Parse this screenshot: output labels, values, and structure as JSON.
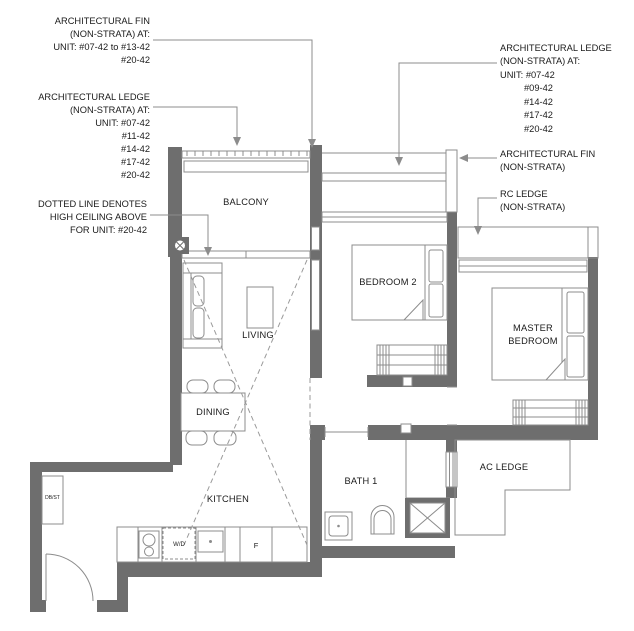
{
  "plan": {
    "annotations": {
      "fin_left": [
        "ARCHITECTURAL FIN",
        "(NON-STRATA) AT:",
        "UNIT: #07-42 to #13-42",
        "#20-42"
      ],
      "ledge_left": [
        "ARCHITECTURAL LEDGE",
        "(NON-STRATA) AT:",
        "UNIT: #07-42",
        "#11-42",
        "#14-42",
        "#17-42",
        "#20-42"
      ],
      "dotted": [
        "DOTTED LINE DENOTES",
        "HIGH CEILING ABOVE",
        "FOR UNIT: #20-42"
      ],
      "ledge_right": [
        "ARCHITECTURAL LEDGE",
        "(NON-STRATA) AT:",
        "UNIT: #07-42",
        "#09-42",
        "#14-42",
        "#17-42",
        "#20-42"
      ],
      "fin_right": [
        "ARCHITECTURAL FIN",
        "(NON-STRATA)"
      ],
      "rc_ledge": [
        "RC LEDGE",
        "(NON-STRATA)"
      ]
    },
    "rooms": {
      "balcony": "BALCONY",
      "living": "LIVING",
      "dining": "DINING",
      "kitchen": "KITCHEN",
      "bedroom2": "BEDROOM 2",
      "master_line1": "MASTER",
      "master_line2": "BEDROOM",
      "bath1": "BATH 1",
      "ac_ledge": "AC LEDGE"
    },
    "fixtures": {
      "db_st": "DB/ST",
      "washer_dryer": "W/D",
      "fridge": "F"
    },
    "colors": {
      "wall": "#6e6e6e",
      "line": "#8c8c8c",
      "text": "#1b1b1b",
      "background": "#ffffff"
    }
  }
}
